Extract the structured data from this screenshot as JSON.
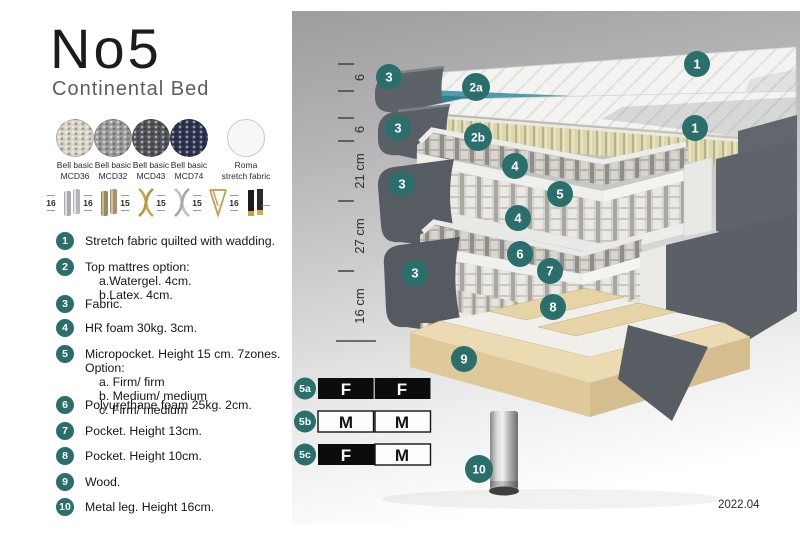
{
  "header": {
    "title": "No5",
    "subtitle": "Continental Bed"
  },
  "swatches": [
    {
      "line1": "Bell basic",
      "line2": "MCD36",
      "color": "#d8d3c6"
    },
    {
      "line1": "Bell basic",
      "line2": "MCD32",
      "color": "#9b9b99"
    },
    {
      "line1": "Bell basic",
      "line2": "MCD43",
      "color": "#54555a"
    },
    {
      "line1": "Bell basic",
      "line2": "MCD74",
      "color": "#2e3450"
    },
    {
      "line1": "Roma",
      "line2": "stretch fabric",
      "color": "#f7f7f7"
    }
  ],
  "legs": {
    "options": [
      {
        "height": "16",
        "type": "chrome-cylinder-legs"
      },
      {
        "height": "16",
        "type": "bronze-cylinder-legs"
      },
      {
        "height": "15",
        "type": "gold-cross-legs"
      },
      {
        "height": "15",
        "type": "silver-cross-legs"
      },
      {
        "height": "15",
        "type": "gold-hairpin-legs"
      },
      {
        "height": "16",
        "type": "black-gold-tip-legs"
      }
    ]
  },
  "list": {
    "items": [
      {
        "num": "1",
        "text": "Stretch fabric quilted with wadding."
      },
      {
        "num": "2",
        "text": "Top mattres option:",
        "subs": [
          "a.Watergel. 4cm.",
          "b.Latex. 4cm."
        ]
      },
      {
        "num": "3",
        "text": "Fabric."
      },
      {
        "num": "4",
        "text": "HR foam 30kg. 3cm."
      },
      {
        "num": "5",
        "text": "Micropocket. Height 15 cm. 7zones. Option:",
        "subs": [
          "a. Firm/ firm",
          "b. Medium/ medium",
          "c. Firm/ medium"
        ]
      },
      {
        "num": "6",
        "text": "Polyurethane foam 25kg. 2cm."
      },
      {
        "num": "7",
        "text": "Pocket. Height 13cm."
      },
      {
        "num": "8",
        "text": "Pocket. Height 10cm."
      },
      {
        "num": "9",
        "text": "Wood."
      },
      {
        "num": "10",
        "text": "Metal leg. Height 16cm."
      }
    ]
  },
  "diagram": {
    "dimensions": [
      {
        "label": "6"
      },
      {
        "label": "6"
      },
      {
        "label": "21 cm"
      },
      {
        "label": "27 cm"
      },
      {
        "label": "16 cm"
      }
    ],
    "callouts": {
      "c1a": "1",
      "c1b": "1",
      "c2a": "2a",
      "c2b": "2b",
      "c3a": "3",
      "c3b": "3",
      "c3c": "3",
      "c3d": "3",
      "c4a": "4",
      "c4b": "4",
      "c5": "5",
      "c6": "6",
      "c7": "7",
      "c8": "8",
      "c9": "9",
      "c10": "10"
    },
    "version": "2022.04"
  },
  "firmness": {
    "rows": [
      {
        "label": "5a",
        "cells": [
          {
            "letter": "F",
            "style": "dark"
          },
          {
            "letter": "F",
            "style": "dark"
          }
        ]
      },
      {
        "label": "5b",
        "cells": [
          {
            "letter": "M",
            "style": "light"
          },
          {
            "letter": "M",
            "style": "light"
          }
        ]
      },
      {
        "label": "5c",
        "cells": [
          {
            "letter": "F",
            "style": "dark"
          },
          {
            "letter": "M",
            "style": "light"
          }
        ]
      }
    ]
  },
  "colors": {
    "accent_teal": "#2b6f6c",
    "watergel": "#2e7f91",
    "latex": "#d9d4ac",
    "fabric_gray": "#5c6167",
    "wood": "#e6d5ac"
  }
}
